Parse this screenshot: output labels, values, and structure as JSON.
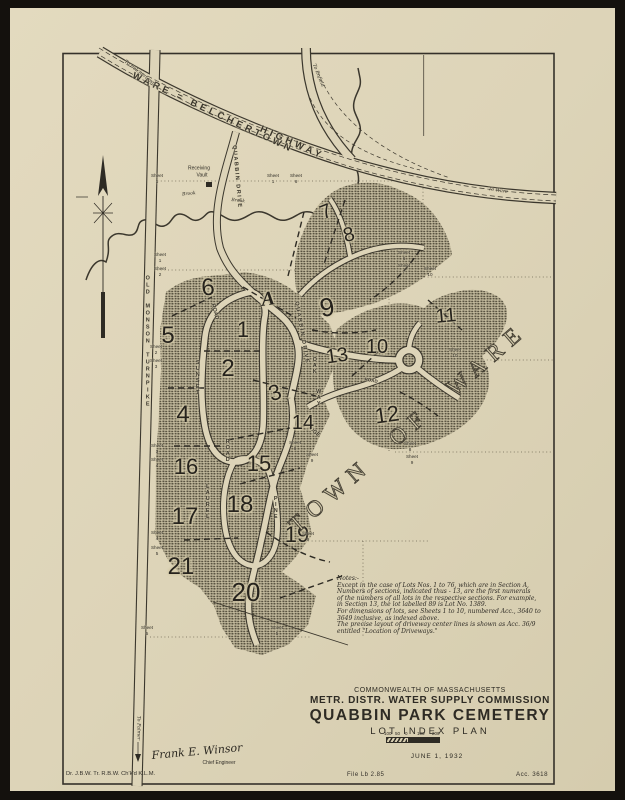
{
  "map": {
    "sheet_word": "Sheet",
    "town_label": "TOWN OF WARE",
    "labels": [
      {
        "name": "highway-label-1",
        "text": "WARE = BELCHERTOWN",
        "x": 213,
        "y": 113,
        "r": 25,
        "s": 9.5,
        "ls": 3.5,
        "cls": "roadname"
      },
      {
        "name": "highway-label-2",
        "text": "HIGHWAY",
        "x": 292,
        "y": 143,
        "r": 24,
        "s": 9.5,
        "ls": 3.5,
        "cls": "roadname"
      },
      {
        "name": "to-belchertown-label",
        "text": "To Belchertown",
        "x": 139,
        "y": 74,
        "r": 38,
        "s": 4.8,
        "cls": "ital"
      },
      {
        "name": "to-enfield-label",
        "text": "To Enfield",
        "x": 317,
        "y": 76,
        "r": 68,
        "s": 4.8,
        "cls": "ital"
      },
      {
        "name": "to-ware-label",
        "text": "To Ware",
        "x": 498,
        "y": 192,
        "r": 9,
        "s": 4.8,
        "cls": "ital"
      },
      {
        "name": "to-palmer-label",
        "text": "To Palmer",
        "x": 137,
        "y": 728,
        "r": 90,
        "s": 4.8,
        "cls": "ital"
      },
      {
        "name": "old-monson-turnpike-label",
        "text": "OLD MONSON TURNPIKE",
        "x": 147,
        "y": 342,
        "vert": 1,
        "s": 5.5,
        "ls": 1,
        "cls": "roadname"
      },
      {
        "name": "quabbin-drive-label",
        "text": "QUABBIN DRIVE",
        "x": 236,
        "y": 177,
        "r": 85,
        "s": 5.5,
        "ls": 1.5,
        "cls": "roadname"
      },
      {
        "name": "quabbin-drive-label-2",
        "text": "QUABBIN DRIVE",
        "x": 301,
        "y": 333,
        "r": 80,
        "s": 5.5,
        "ls": 1.5,
        "cls": "roadname"
      },
      {
        "name": "sunset-road-label-1",
        "text": "SUNSET",
        "x": 197,
        "y": 378,
        "vert": 1,
        "s": 5.5,
        "cls": "roadname"
      },
      {
        "name": "sunset-road-label-2",
        "text": "ROAD",
        "x": 214,
        "y": 312,
        "r": 75,
        "s": 5.5,
        "cls": "roadname"
      },
      {
        "name": "laurel-road-label-1",
        "text": "LAUREL",
        "x": 207,
        "y": 502,
        "vert": 1,
        "s": 5.5,
        "cls": "roadname"
      },
      {
        "name": "laurel-road-label-2",
        "text": "ROAD",
        "x": 227,
        "y": 451,
        "vert": 1,
        "s": 5.5,
        "cls": "roadname"
      },
      {
        "name": "pine-ridge-label-1",
        "text": "PINE",
        "x": 275,
        "y": 508,
        "vert": 1,
        "s": 5.5,
        "cls": "roadname"
      },
      {
        "name": "pine-ridge-label-2",
        "text": "RIDGE",
        "x": 312,
        "y": 431,
        "r": 42,
        "s": 5.5,
        "cls": "roadname"
      },
      {
        "name": "oak-way-label-1",
        "text": "OAK",
        "x": 314,
        "y": 366,
        "vert": 1,
        "s": 5.5,
        "cls": "roadname"
      },
      {
        "name": "oak-way-label-2",
        "text": "WAY",
        "x": 318,
        "y": 398,
        "vert": 1,
        "s": 5.5,
        "cls": "roadname"
      },
      {
        "name": "road-label",
        "text": "ROAD",
        "x": 371,
        "y": 381,
        "r": 10,
        "s": 4.5,
        "cls": "roadname"
      },
      {
        "name": "brook-label-1",
        "text": "Brook",
        "x": 189,
        "y": 195,
        "r": -6,
        "s": 4.5,
        "cls": "ital"
      },
      {
        "name": "brook-label-2",
        "text": "Brook",
        "x": 238,
        "y": 202,
        "r": 6,
        "s": 4.5,
        "cls": "ital"
      },
      {
        "name": "receiving-vault-label-1",
        "text": "Receiving",
        "x": 199,
        "y": 169,
        "s": 5
      },
      {
        "name": "receiving-vault-label-2",
        "text": "Vault",
        "x": 202,
        "y": 176,
        "s": 5
      }
    ],
    "sections": [
      {
        "n": "7",
        "x": 326,
        "y": 212,
        "s": 20,
        "r": -22
      },
      {
        "n": "8",
        "x": 349,
        "y": 235,
        "s": 20,
        "r": -15
      },
      {
        "n": "6",
        "x": 208,
        "y": 288,
        "s": 24,
        "r": -4
      },
      {
        "n": "A",
        "x": 268,
        "y": 299,
        "s": 20,
        "r": -8,
        "serif": 1
      },
      {
        "n": "9",
        "x": 327,
        "y": 307,
        "s": 26,
        "r": -10
      },
      {
        "n": "1",
        "x": 243,
        "y": 330,
        "s": 22,
        "r": 0
      },
      {
        "n": "5",
        "x": 168,
        "y": 336,
        "s": 24,
        "r": 0
      },
      {
        "n": "2",
        "x": 228,
        "y": 369,
        "s": 24,
        "r": 0
      },
      {
        "n": "3",
        "x": 275,
        "y": 393,
        "s": 22,
        "r": -18
      },
      {
        "n": "13",
        "x": 337,
        "y": 356,
        "s": 20,
        "r": -8
      },
      {
        "n": "10",
        "x": 377,
        "y": 347,
        "s": 20,
        "r": 0
      },
      {
        "n": "11",
        "x": 446,
        "y": 316,
        "s": 20,
        "r": -5
      },
      {
        "n": "4",
        "x": 183,
        "y": 415,
        "s": 24,
        "r": 0
      },
      {
        "n": "14",
        "x": 303,
        "y": 423,
        "s": 20,
        "r": 0
      },
      {
        "n": "12",
        "x": 387,
        "y": 415,
        "s": 22,
        "r": -8
      },
      {
        "n": "16",
        "x": 186,
        "y": 467,
        "s": 22,
        "r": 0
      },
      {
        "n": "15",
        "x": 259,
        "y": 464,
        "s": 22,
        "r": 0
      },
      {
        "n": "17",
        "x": 185,
        "y": 517,
        "s": 24,
        "r": 0
      },
      {
        "n": "18",
        "x": 240,
        "y": 505,
        "s": 24,
        "r": 0
      },
      {
        "n": "19",
        "x": 297,
        "y": 535,
        "s": 22,
        "r": 0
      },
      {
        "n": "21",
        "x": 181,
        "y": 567,
        "s": 24,
        "r": 0
      },
      {
        "n": "20",
        "x": 246,
        "y": 592,
        "s": 26,
        "r": 0
      }
    ],
    "sheet_labels": [
      {
        "x": 157,
        "y": 173,
        "n": "1"
      },
      {
        "x": 273,
        "y": 173,
        "n": "1"
      },
      {
        "x": 296,
        "y": 173,
        "n": "6"
      },
      {
        "x": 160,
        "y": 252,
        "n": "1"
      },
      {
        "x": 160,
        "y": 266,
        "n": "2"
      },
      {
        "x": 156,
        "y": 344,
        "n": "2"
      },
      {
        "x": 156,
        "y": 358,
        "n": "3"
      },
      {
        "x": 157,
        "y": 443,
        "n": "3"
      },
      {
        "x": 157,
        "y": 457,
        "n": "4"
      },
      {
        "x": 157,
        "y": 530,
        "n": "4"
      },
      {
        "x": 157,
        "y": 545,
        "n": "5"
      },
      {
        "x": 147,
        "y": 625,
        "n": "5"
      },
      {
        "x": 277,
        "y": 625,
        "n": "5"
      },
      {
        "x": 404,
        "y": 250,
        "n": "6"
      },
      {
        "x": 404,
        "y": 263,
        "n": "7"
      },
      {
        "x": 430,
        "y": 266,
        "n": "10"
      },
      {
        "x": 455,
        "y": 347,
        "n": "10"
      },
      {
        "x": 295,
        "y": 440,
        "n": "8"
      },
      {
        "x": 312,
        "y": 452,
        "n": "9"
      },
      {
        "x": 410,
        "y": 441,
        "n": "8"
      },
      {
        "x": 412,
        "y": 454,
        "n": "9"
      },
      {
        "x": 308,
        "y": 531,
        "n": "9"
      }
    ]
  },
  "notes": {
    "text": "Notes:-\n  Except in the case of Lots Nos. 1 to 76, which are in Section A,\nNumbers of sections, indicated thus - 13, are the first numerals\nof the numbers of all lots in the respective sections. For example,\nin Section 13, the lot labelled 89 is Lot No. 1389.\n  For dimensions of lots, see Sheets 1 to 10, numbered Acc., 3640 to\n3649 inclusive, as indexed above.\n  The precise layout of driveway center lines is shown as Acc. 36/9\nentitled \"Location of Driveways.\""
  },
  "title_block": {
    "line1": "COMMONWEALTH OF MASSACHUSETTS",
    "line2": "METR. DISTR. WATER SUPPLY COMMISSION",
    "line3": "QUABBIN PARK CEMETERY",
    "line4": "LOT INDEX PLAN",
    "date": "JUNE 1, 1932",
    "scale_labels": [
      "100",
      "50",
      "0",
      "100",
      "200 FT."
    ]
  },
  "footer": {
    "drafters": "Dr. J.B.W.   Tr. R.B.W.   Ch'k'd  K.L.M.",
    "signature": "Frank E. Winsor",
    "signature_title": "Chief Engineer",
    "file": "File Lb 2.85",
    "acc": "Acc. 3618"
  },
  "colors": {
    "paper": "#ddd4b8",
    "ink": "#3b372d",
    "scan_border": "#14110d"
  }
}
